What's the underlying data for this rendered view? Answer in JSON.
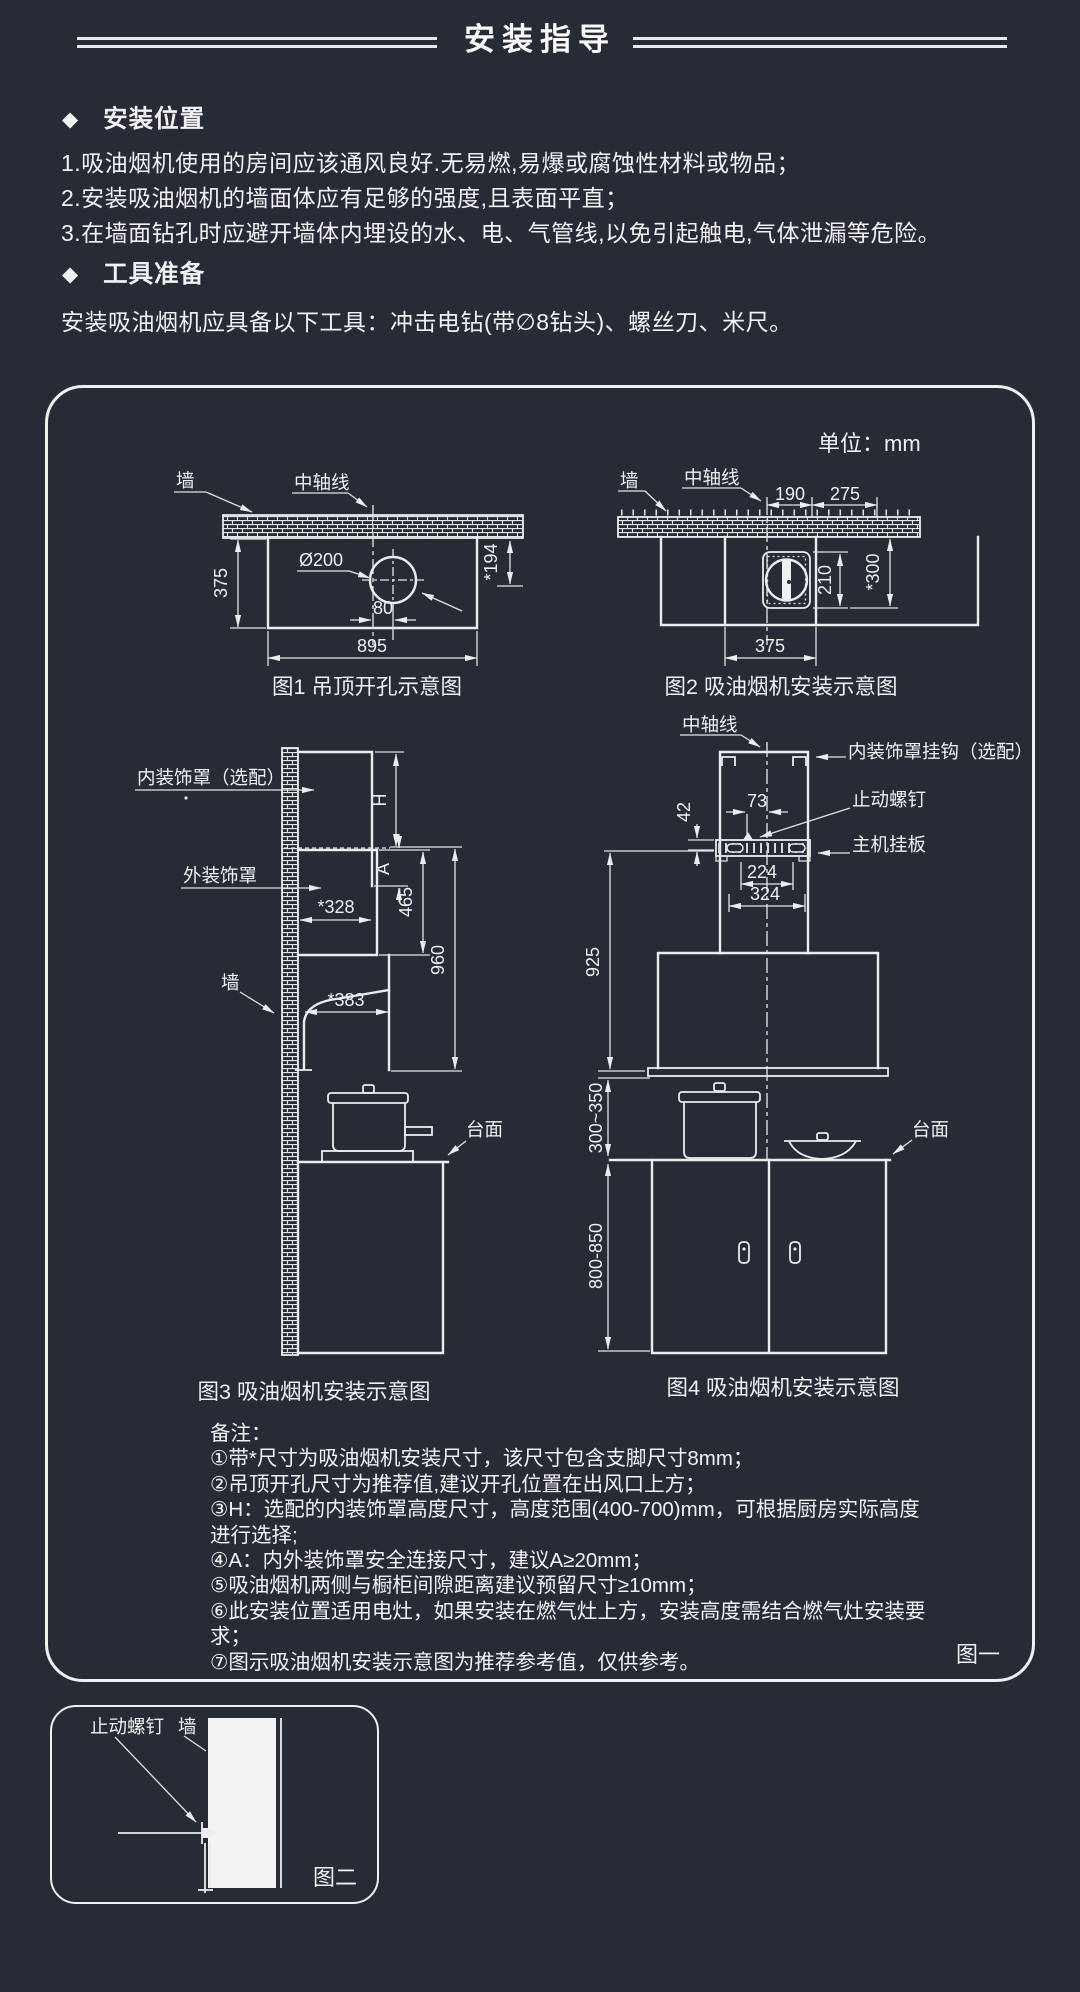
{
  "page": {
    "title": "安装指导",
    "bullet": "◆",
    "unit_label": "单位：mm",
    "fig_one_label": "图一",
    "fig_two_label": "图二"
  },
  "sections": {
    "location": {
      "heading": "安装位置",
      "items": [
        "1.吸油烟机使用的房间应该通风良好.无易燃,易爆或腐蚀性材料或物品；",
        "2.安装吸油烟机的墙面体应有足够的强度,且表面平直；",
        "3.在墙面钻孔时应避开墙体内埋设的水、电、气管线,以免引起触电,气体泄漏等危险。"
      ]
    },
    "tools": {
      "heading": "工具准备",
      "text": "安装吸油烟机应具备以下工具：冲击电钻(带∅8钻头)、螺丝刀、米尺。"
    }
  },
  "fig1": {
    "caption": "图1 吊顶开孔示意图",
    "wall": "墙",
    "axis": "中轴线",
    "dia": "Ø200",
    "d375": "375",
    "d895": "895",
    "d80": "80",
    "d194": "*194"
  },
  "fig2": {
    "caption": "图2 吸油烟机安装示意图",
    "wall": "墙",
    "axis": "中轴线",
    "d190": "190",
    "d275": "275",
    "d210": "210",
    "d300": "*300",
    "d375": "375"
  },
  "fig3": {
    "caption": "图3 吸油烟机安装示意图",
    "inner_label": "内装饰罩（选配）",
    "outer_label": "外装饰罩",
    "wall": "墙",
    "counter": "台面",
    "dH": "H",
    "dA": "A",
    "d328": "*328",
    "d465": "465",
    "d960": "960",
    "d383": "*383"
  },
  "fig4": {
    "caption": "图4 吸油烟机安装示意图",
    "axis": "中轴线",
    "hook_label": "内装饰罩挂钩（选配）",
    "screw_label": "止动螺钉",
    "plate_label": "主机挂板",
    "counter": "台面",
    "d73": "73",
    "d42": "42",
    "d224": "224",
    "d324": "324",
    "d925": "925",
    "d300_350": "300~350",
    "d800_850": "800-850"
  },
  "notes": {
    "heading": "备注：",
    "items": [
      "①带*尺寸为吸油烟机安装尺寸，该尺寸包含支脚尺寸8mm；",
      "②吊顶开孔尺寸为推荐值,建议开孔位置在出风口上方；",
      "③H：选配的内装饰罩高度尺寸，高度范围(400-700)mm，可根据厨房实际高度进行选择;",
      "④A：内外装饰罩安全连接尺寸，建议A≥20mm；",
      "⑤吸油烟机两侧与橱柜间隙距离建议预留尺寸≥10mm；",
      "⑥此安装位置适用电灶，如果安装在燃气灶上方，安装高度需结合燃气灶安装要求；",
      "⑦图示吸油烟机安装示意图为推荐参考值，仅供参考。"
    ]
  },
  "detail_box": {
    "screw_label": "止动螺钉",
    "wall_label": "墙"
  }
}
